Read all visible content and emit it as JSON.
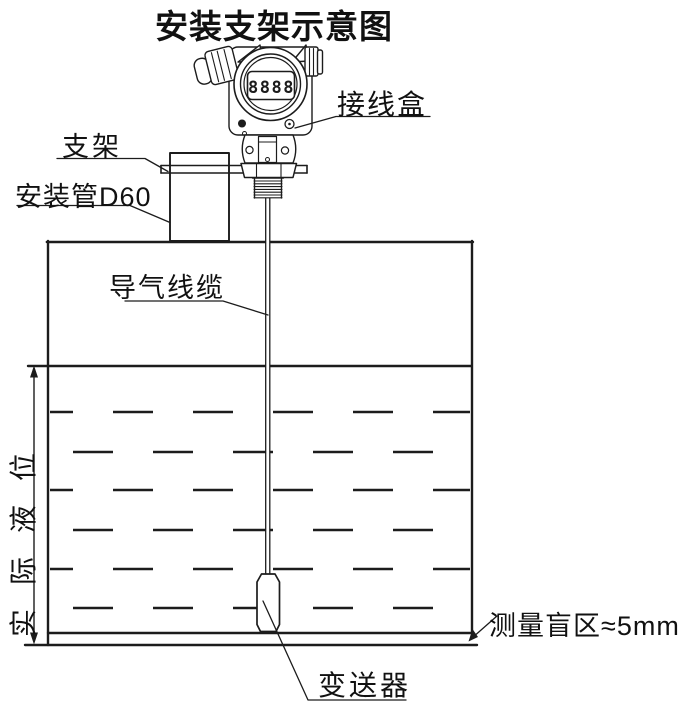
{
  "title": "安装支架示意图",
  "labels": {
    "junction_box": "接线盒",
    "bracket": "支架",
    "mounting_pipe": "安装管D60",
    "air_cable": "导气线缆",
    "actual_level": "实际液位",
    "transmitter": "变送器",
    "blind_zone": "测量盲区≈5mm"
  },
  "device": {
    "display_value": "8888"
  },
  "colors": {
    "line": "#1c1c1c",
    "background": "#ffffff"
  }
}
